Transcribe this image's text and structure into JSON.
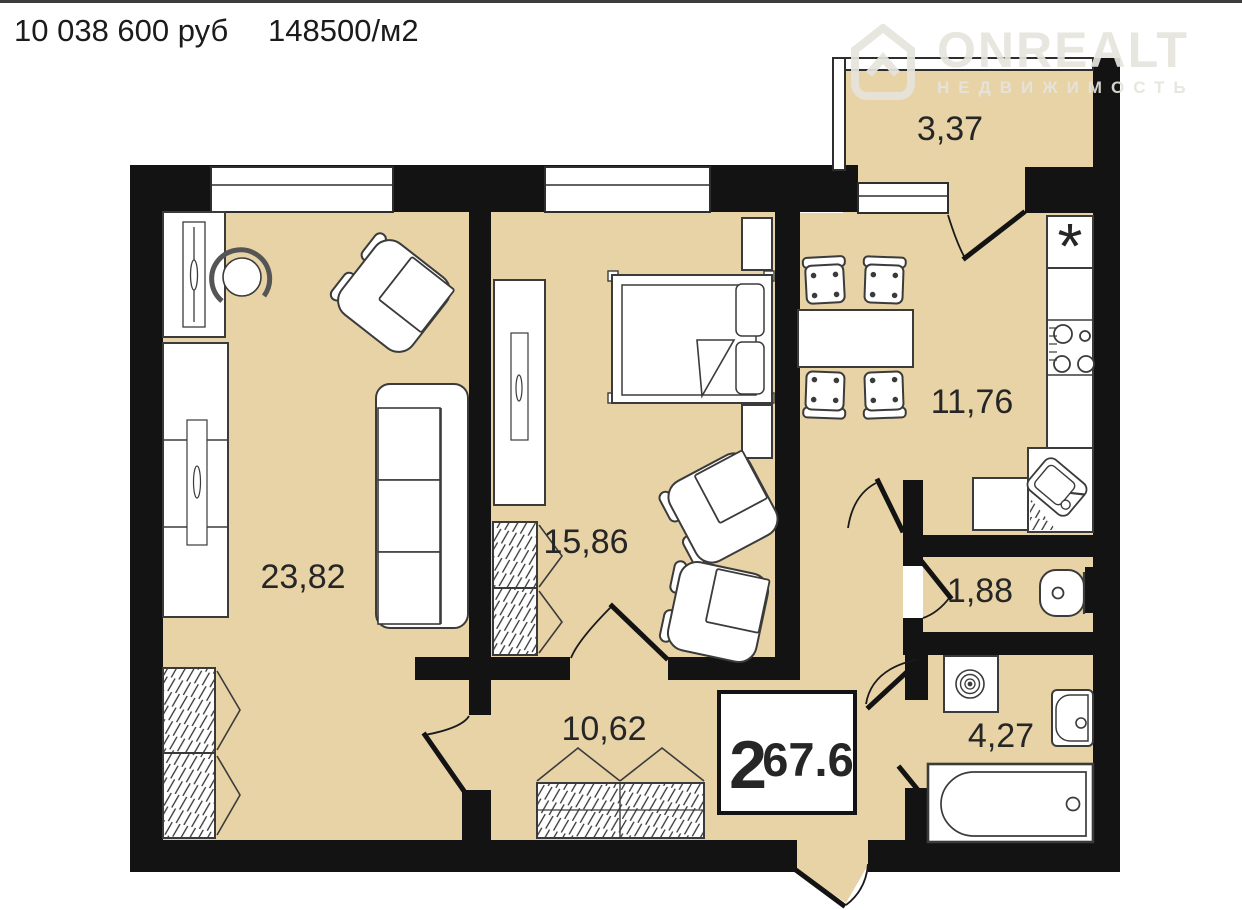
{
  "header": {
    "price": "10 038 600 руб",
    "price_per_m2": "148500/м2"
  },
  "watermark": {
    "brand": "ONREALT",
    "subtitle": "НЕДВИЖИМОСТЬ"
  },
  "plan": {
    "type": "apartment-floor-plan",
    "summary": {
      "rooms_count": "2",
      "total_area": "67.6"
    },
    "room_areas": {
      "living_room": "23,82",
      "bedroom": "15,86",
      "kitchen": "11,76",
      "hallway": "10,62",
      "bathroom": "4,27",
      "wc": "1,88",
      "balcony": "3,37"
    },
    "symbols": {
      "fridge": "*"
    },
    "colors": {
      "floor": "#e7d3a6",
      "wall": "#131313",
      "furniture_fill": "#ffffff",
      "furniture_outline": "#3b3b3b",
      "label_text": "#262626",
      "watermark": "#e6e4dd",
      "top_line": "#3d3d3d"
    }
  }
}
